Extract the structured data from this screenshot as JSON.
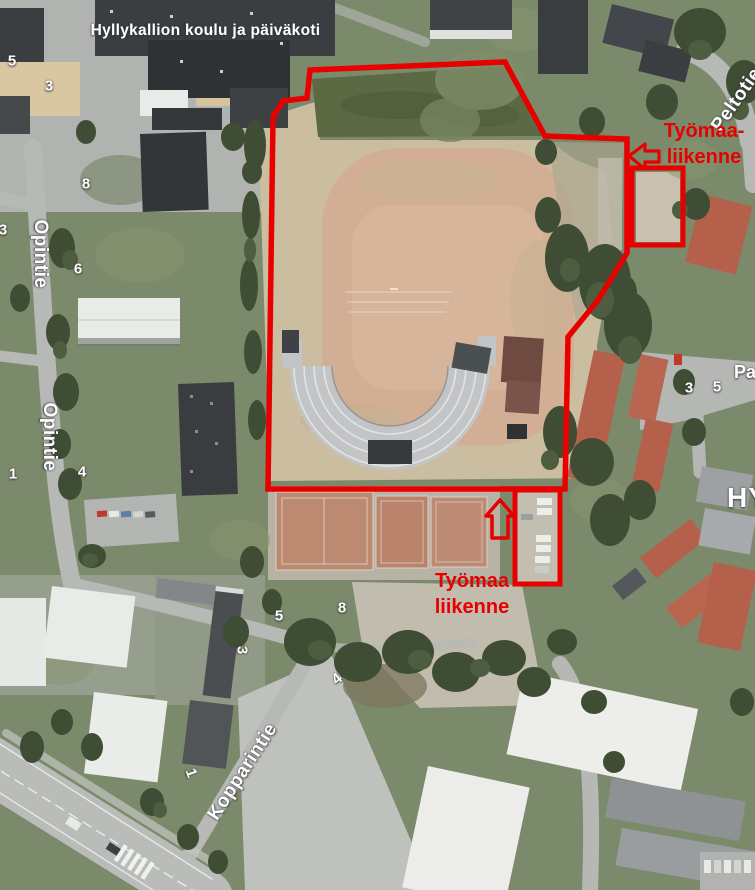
{
  "map": {
    "type": "aerial-photograph",
    "place_label": "Hyllykallion koulu ja päiväkoti",
    "street_labels": [
      {
        "name": "opintie-north",
        "text": "Opintie"
      },
      {
        "name": "opintie-south",
        "text": "Opintie"
      },
      {
        "name": "kopparintie",
        "text": "Kopparintie"
      },
      {
        "name": "peltotie-partial",
        "text": "Peltotie"
      },
      {
        "name": "pa-partial",
        "text": "Pa"
      },
      {
        "name": "hy-partial",
        "text": "HY"
      }
    ],
    "house_numbers": [
      {
        "text": "5"
      },
      {
        "text": "3"
      },
      {
        "text": "8"
      },
      {
        "text": "3"
      },
      {
        "text": "6"
      },
      {
        "text": "1"
      },
      {
        "text": "4"
      },
      {
        "text": "5"
      },
      {
        "text": "8"
      },
      {
        "text": "3"
      },
      {
        "text": "4"
      },
      {
        "text": "3"
      },
      {
        "text": "5"
      },
      {
        "text": "1"
      }
    ]
  },
  "annotations": {
    "labels": {
      "northeast": {
        "line1": "Työmaa-",
        "line2": "liikenne"
      },
      "south": {
        "line1": "Työmaa",
        "line2": "liikenne"
      }
    },
    "arrows": [
      {
        "name": "northeast-entrance-arrow",
        "direction": "left"
      },
      {
        "name": "south-entrance-arrow",
        "direction": "up"
      }
    ]
  },
  "colors": {
    "annotation_red": "#e80000",
    "map_label_white": "#ffffff"
  }
}
